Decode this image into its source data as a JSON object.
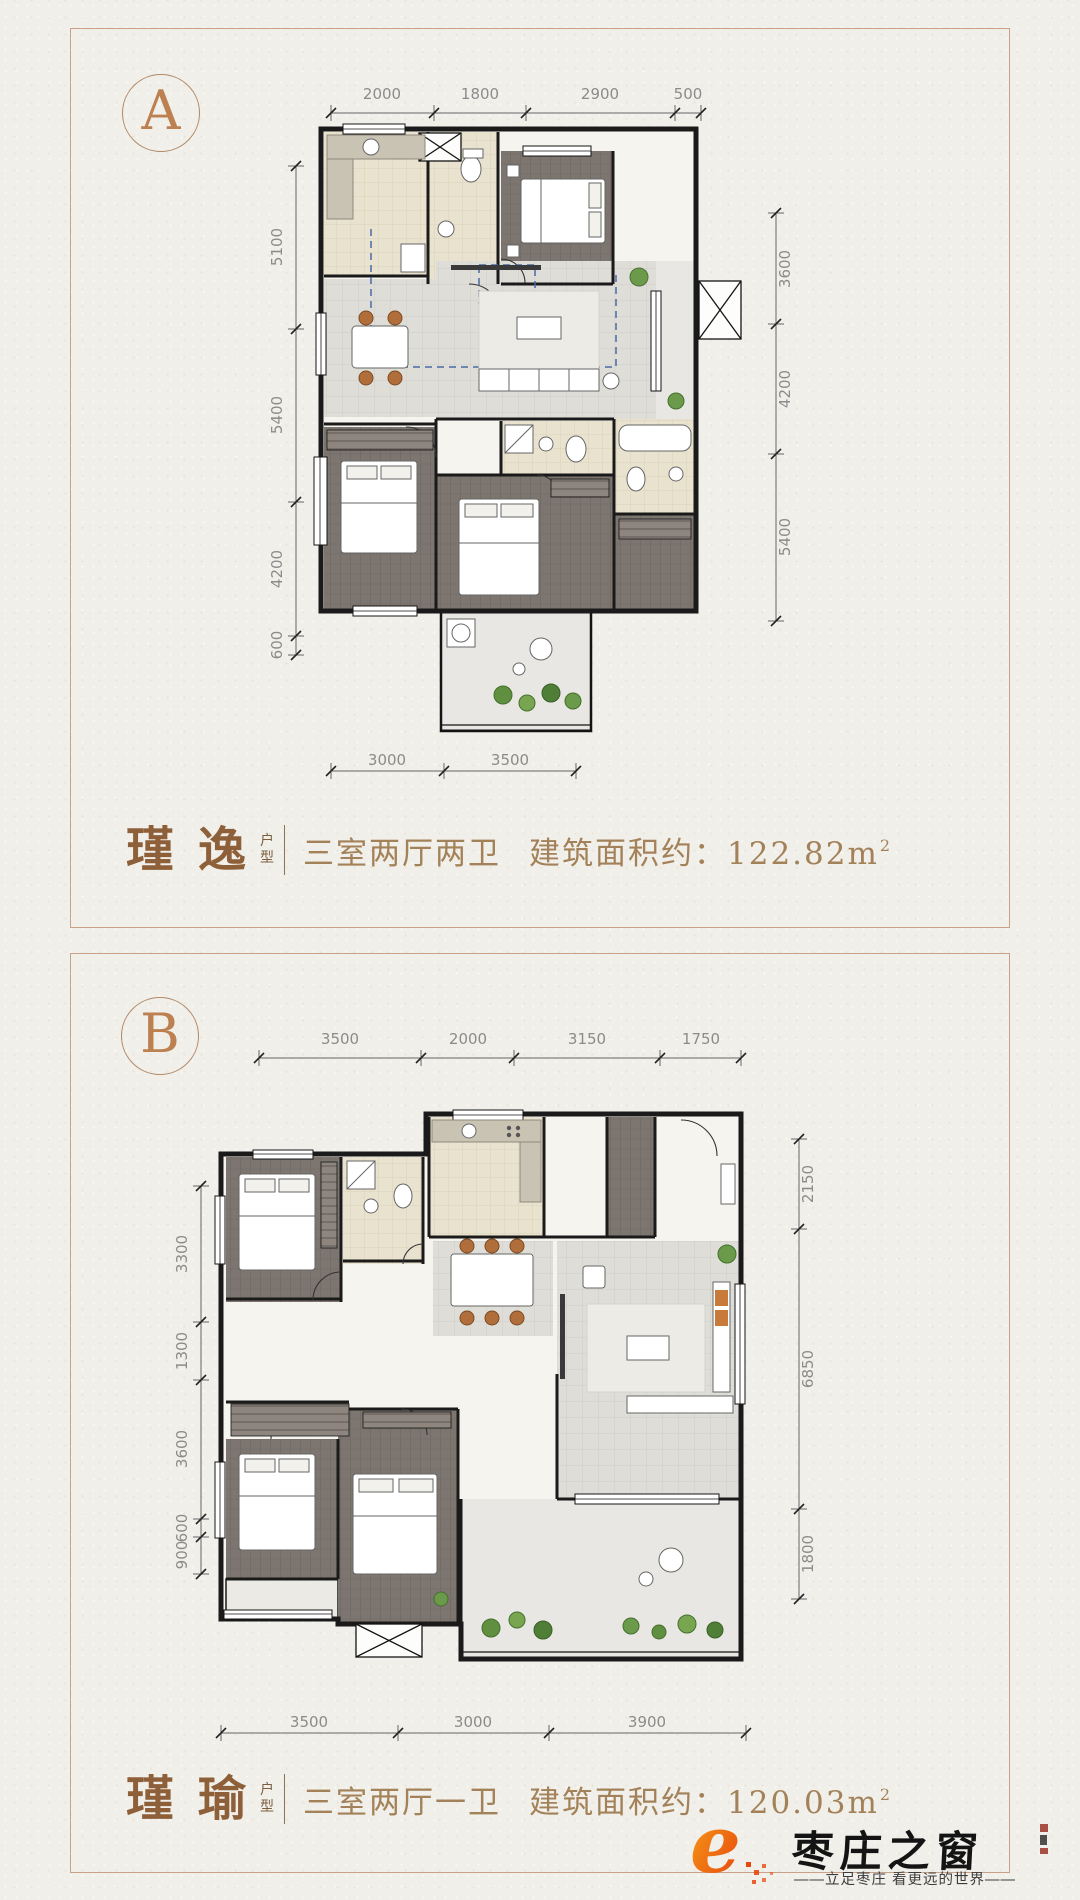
{
  "colors": {
    "accent_bronze": "#bd8050",
    "caption_text": "#a3825a",
    "panel_border": "#c8a188",
    "logo_orange": "#ee5a0f",
    "paper": "#f1efe9"
  },
  "panels": [
    {
      "badge": "A",
      "caption": {
        "name": "瑾逸",
        "type_top": "户",
        "type_bottom": "型",
        "layout": "三室两厅两卫",
        "area_label": "建筑面积约：",
        "area_value": "122.82m",
        "area_sup": "2"
      },
      "dims": {
        "top": [
          "2000",
          "1800",
          "2900",
          "500"
        ],
        "left": [
          "5100",
          "5400",
          "4200",
          "600"
        ],
        "right": [
          "3600",
          "4200",
          "5400"
        ],
        "bottom": [
          "3000",
          "3500"
        ]
      }
    },
    {
      "badge": "B",
      "caption": {
        "name": "瑾瑜",
        "type_top": "户",
        "type_bottom": "型",
        "layout": "三室两厅一卫",
        "area_label": "建筑面积约：",
        "area_value": "120.03m",
        "area_sup": "2"
      },
      "dims": {
        "top": [
          "3500",
          "2000",
          "3150",
          "1750"
        ],
        "left": [
          "3300",
          "1300",
          "3600",
          "600",
          "900"
        ],
        "right": [
          "2150",
          "6850",
          "1800"
        ],
        "bottom": [
          "3500",
          "3000",
          "3900"
        ]
      }
    }
  ],
  "logo": {
    "name": "枣庄之窗",
    "tagline": "——立足枣庄 看更远的世界——"
  }
}
